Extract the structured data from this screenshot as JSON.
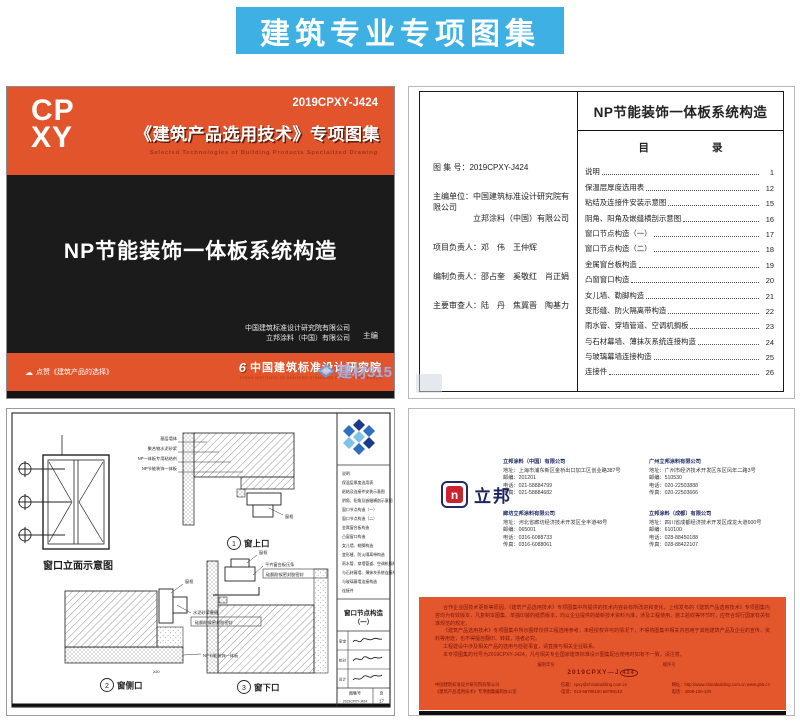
{
  "banner": {
    "title": "建筑专业专项图集"
  },
  "cover": {
    "logo_line1": "CP",
    "logo_line2": "XY",
    "code": "2019CPXY-J424",
    "series_title": "《建筑产品选用技术》专项图集",
    "series_subtitle": "Selected Technologies of Building Products Specialized Drawing",
    "main_title": "NP节能装饰一体板系统构造",
    "editor_line1": "中国建筑标准设计研究院有限公司",
    "editor_line2": "立邦涂料（中国）有限公司",
    "editor_role": "主编",
    "footer_left": "点赞《建筑产品的选择》",
    "footer_right": "中国建筑标准设计研究院",
    "footer_right_en": "CHINA INSTITUTE OF BUILDING STANDARD DESIGN & RESEARCH"
  },
  "watermark": {
    "text": "建材315"
  },
  "toc": {
    "title": "NP节能装饰一体板系统构造",
    "heading": "目　　　　　　录",
    "fields": [
      {
        "label": "图 集 号：",
        "value": "2019CPXY-J424"
      },
      {
        "label": "主编单位：",
        "value": "中国建筑标准设计研究院有限公司",
        "value2": "立邦涂料（中国）有限公司"
      },
      {
        "label": "项目负责人：",
        "value": "邓　伟　王仲辉"
      },
      {
        "label": "编制负责人：",
        "value": "邵占奎　奚敬红　肖正娟"
      },
      {
        "label": "主要审查人：",
        "value": "陆　丹　焦冀晋　陶基力"
      }
    ],
    "items": [
      {
        "label": "说明",
        "page": "1"
      },
      {
        "label": "保温层厚度选用表",
        "page": "12"
      },
      {
        "label": "粘结及连接件安装示意图",
        "page": "15"
      },
      {
        "label": "阴角、阳角及嵌缝横剖示意图",
        "page": "16"
      },
      {
        "label": "窗口节点构造（一）",
        "page": "17"
      },
      {
        "label": "窗口节点构造（二）",
        "page": "18"
      },
      {
        "label": "金属窗台板构造",
        "page": "19"
      },
      {
        "label": "凸窗窗口构造",
        "page": "20"
      },
      {
        "label": "女儿墙、勒脚构造",
        "page": "21"
      },
      {
        "label": "变形缝、防火隔离带构造",
        "page": "22"
      },
      {
        "label": "雨水管、穿墙管道、空调机搁板",
        "page": "23"
      },
      {
        "label": "与石材幕墙、薄抹灰系统连接构造",
        "page": "24"
      },
      {
        "label": "与玻璃幕墙连接构造",
        "page": "25"
      },
      {
        "label": "连接件",
        "page": "26"
      }
    ]
  },
  "drawing": {
    "elevation_caption": "窗口立面示意图",
    "layers": [
      "基层墙体",
      "聚合物水泥砂浆",
      "NP一体板专用粘结剂",
      "NP节能装饰一体板"
    ],
    "frame_label": "窗框",
    "mortar_label": "水泥砂浆塞缝",
    "sealant_label": "硅酮耐候密封胶密封",
    "board_label": "NP节能装饰一体板",
    "sill_label": "平齐窗台板压条",
    "dim_label": "≥20",
    "details": [
      {
        "no": "1",
        "label": "窗上口"
      },
      {
        "no": "2",
        "label": "窗侧口"
      },
      {
        "no": "3",
        "label": "窗下口"
      }
    ],
    "titleblock": {
      "title_line1": "窗口节点构造",
      "title_line2": "（一）",
      "sig1": "审定",
      "sig2": "校对",
      "sig3": "设计",
      "code_label": "图集号",
      "code": "2019CPXY-J424",
      "page_label": "页",
      "page": "17"
    }
  },
  "back": {
    "logo_text": "立邦",
    "contacts": [
      {
        "name": "立邦涂料（中国）有限公司",
        "address": "地址：上海市浦东新区金桥出口加工区创业路387号",
        "zip": "邮编：201201",
        "tel": "电话：021-58884799",
        "fax": "传真：021-58884682"
      },
      {
        "name": "廊坊立邦涂料有限公司",
        "address": "地址：河北省廊坊经济技术开发区全丰道48号",
        "zip": "邮编：065001",
        "tel": "电话：0316-6088733",
        "fax": "传真：0316-6088061"
      },
      {
        "name": "广州立邦涂料有限公司",
        "address": "地址：广州市经济技术开发区东区凤年二路3号",
        "zip": "邮编：510530",
        "tel": "电话：020-22503888",
        "fax": "传真：020-22503666"
      },
      {
        "name": "立邦涂料（成都）有限公司",
        "address": "地址：四川省成都经济技术开发区成龙大道600号",
        "zip": "邮编：610100",
        "tel": "电话：028-88450188",
        "fax": "传真：028-88422107"
      }
    ],
    "paragraphs": [
      "合作企业因技术更新等原因，《建筑产品选用技术》专项图集中所提供的技术内容会有所改进和变化，上线发布的《建筑产品选用技术》专项图集内容均为有效版本，凡复制本图集、单独印装的纸质版本，均以企业提供的最新技术资料为准，涉及工程使用、施工验收等环节时，应符合现行国家有关标准规范的规定。",
      "《建筑产品选用技术》专项图集中所示图样仅供工程选用参考，未经授权许可的情况下，不得将图集中相关内容用于其他建筑产品及企业的宣传、资料等用途，也不得擅自翻印、转载，违者必究。",
      "工程建设中涉及相关产品的选用与检验事宜，请直接与相关企业联系。",
      "本专项图集的代号为2019CPXY-J424，凡与相关专业国家建筑标准设计图集配合使用时如有不一致，请注意。"
    ],
    "code_diagram": {
      "year_label": "编制年份",
      "seq_label": "顺序号",
      "code_main": "2019CPXY—J",
      "code_seq": "424"
    },
    "footer_cols": [
      {
        "line1": "中国建筑标准设计研究院有限公司",
        "line2": "《建筑产品选用技术》专项图集编制办公室"
      },
      {
        "line1": "信箱：cpxy@chinabuilding.com.cn",
        "line2": "电话：010-68799100  68799143"
      },
      {
        "line1": "网址：http://www.chinabuilding.com.cn  www.gb5.cn",
        "line2": "电话：4008-100-100"
      }
    ]
  }
}
